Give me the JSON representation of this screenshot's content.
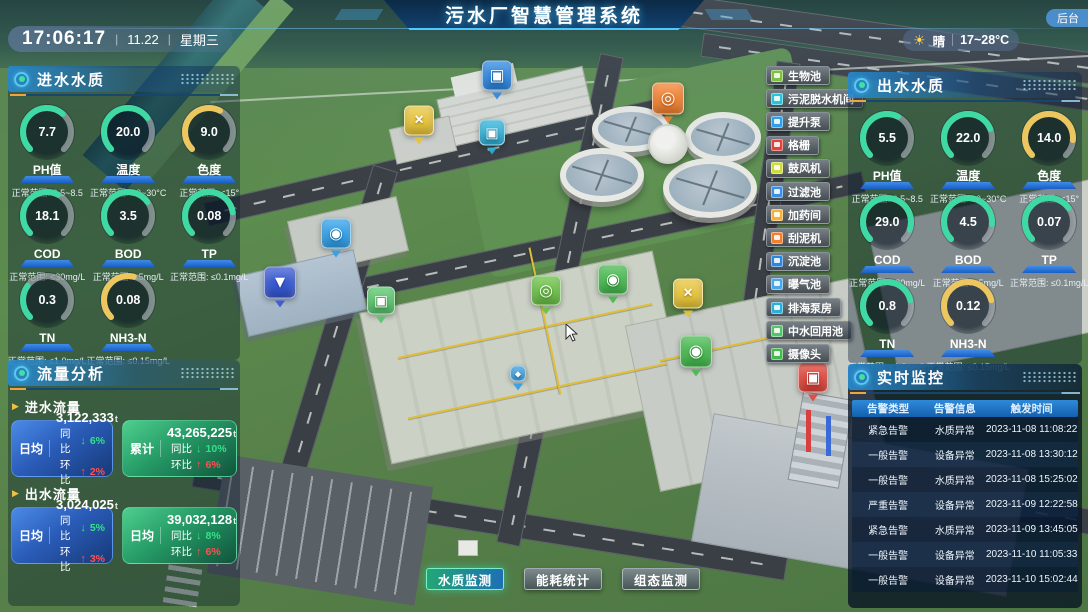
{
  "titlebar": {
    "title": "污水厂智慧管理系统",
    "backend_label": "后台",
    "clock": {
      "time": "17:06:17",
      "date": "11.22",
      "weekday": "星期三",
      "sep": "|"
    },
    "weather": {
      "icon": "☀",
      "condition": "晴",
      "temp_range": "17~28°C"
    }
  },
  "colors": {
    "gauge_green": "#3fd9a4",
    "gauge_yellow": "#ecc65e",
    "accent_cyan": "#4ec8ff",
    "up_red": "#ff5050",
    "down_green": "#35e08a",
    "card_blue": "#2f74d8",
    "card_green": "#2fae72"
  },
  "influent_panel": {
    "title": "进水水质",
    "gauges": [
      {
        "label": "PH值",
        "value": "7.7",
        "range": "正常范围: 6.5~8.5",
        "color": "green",
        "pct": 65
      },
      {
        "label": "温度",
        "value": "20.0",
        "range": "正常范围: 20~30°C",
        "color": "green",
        "pct": 70
      },
      {
        "label": "色度",
        "value": "9.0",
        "range": "正常范围: <15°",
        "color": "yellow",
        "pct": 60
      },
      {
        "label": "COD",
        "value": "18.1",
        "range": "正常范围: ≤30mg/L",
        "color": "green",
        "pct": 60
      },
      {
        "label": "BOD",
        "value": "3.5",
        "range": "正常范围: ≤5mg/L",
        "color": "green",
        "pct": 70
      },
      {
        "label": "TP",
        "value": "0.08",
        "range": "正常范围: ≤0.1mg/L",
        "color": "green",
        "pct": 80
      },
      {
        "label": "TN",
        "value": "0.3",
        "range": "正常范围: ≤1.0mg/L",
        "color": "green",
        "pct": 30
      },
      {
        "label": "NH3-N",
        "value": "0.08",
        "range": "正常范围: ≤0.15mg/L",
        "color": "yellow",
        "pct": 55
      }
    ]
  },
  "effluent_panel": {
    "title": "出水水质",
    "gauges": [
      {
        "label": "PH值",
        "value": "5.5",
        "range": "正常范围: 6.5~8.5",
        "color": "green",
        "pct": 60
      },
      {
        "label": "温度",
        "value": "22.0",
        "range": "正常范围: 20~30°C",
        "color": "green",
        "pct": 75
      },
      {
        "label": "色度",
        "value": "14.0",
        "range": "正常范围: <15°",
        "color": "yellow",
        "pct": 85
      },
      {
        "label": "COD",
        "value": "29.0",
        "range": "正常范围: ≤30mg/L",
        "color": "green",
        "pct": 90
      },
      {
        "label": "BOD",
        "value": "4.5",
        "range": "正常范围: ≤5mg/L",
        "color": "green",
        "pct": 85
      },
      {
        "label": "TP",
        "value": "0.07",
        "range": "正常范围: ≤0.1mg/L",
        "color": "green",
        "pct": 70
      },
      {
        "label": "TN",
        "value": "0.8",
        "range": "正常范围: ≤1.0mg/L",
        "color": "green",
        "pct": 78
      },
      {
        "label": "NH3-N",
        "value": "0.12",
        "range": "正常范围: ≤0.15mg/L",
        "color": "yellow",
        "pct": 78
      }
    ]
  },
  "flow_panel": {
    "title": "流量分析",
    "yoy_label": "同比",
    "mom_label": "环比",
    "groups": [
      {
        "label": "进水流量",
        "cards": [
          {
            "theme": "blue",
            "stat": "日均",
            "value": "3,122,333",
            "unit": "t",
            "yoy": "6%",
            "mom": "2%"
          },
          {
            "theme": "green",
            "stat": "累计",
            "value": "43,265,225",
            "unit": "t",
            "yoy": "10%",
            "mom": "6%"
          }
        ]
      },
      {
        "label": "出水流量",
        "cards": [
          {
            "theme": "blue",
            "stat": "日均",
            "value": "3,024,025",
            "unit": "t",
            "yoy": "5%",
            "mom": "3%"
          },
          {
            "theme": "green",
            "stat": "日均",
            "value": "39,032,128",
            "unit": "t",
            "yoy": "8%",
            "mom": "6%"
          }
        ]
      }
    ]
  },
  "monitor_panel": {
    "title": "实时监控",
    "columns": [
      "告警类型",
      "告警信息",
      "触发时间"
    ],
    "rows": [
      [
        "紧急告警",
        "水质异常",
        "2023-11-08 11:08:22"
      ],
      [
        "一般告警",
        "设备异常",
        "2023-11-08 13:30:12"
      ],
      [
        "一般告警",
        "水质异常",
        "2023-11-08 15:25:02"
      ],
      [
        "严重告警",
        "设备异常",
        "2023-11-09 12:22:58"
      ],
      [
        "紧急告警",
        "水质异常",
        "2023-11-09 13:45:05"
      ],
      [
        "一般告警",
        "设备异常",
        "2023-11-10 11:05:33"
      ],
      [
        "一般告警",
        "设备异常",
        "2023-11-10 15:02:44"
      ]
    ]
  },
  "facility_buttons": [
    {
      "label": "生物池",
      "color": "#7cc142"
    },
    {
      "label": "污泥脱水机间",
      "color": "#29c5d6"
    },
    {
      "label": "提升泵",
      "color": "#2e9fe8"
    },
    {
      "label": "格栅",
      "color": "#e04438"
    },
    {
      "label": "鼓风机",
      "color": "#cfdd3c"
    },
    {
      "label": "过滤池",
      "color": "#3a8ee6"
    },
    {
      "label": "加药间",
      "color": "#f2b03c"
    },
    {
      "label": "刮泥机",
      "color": "#f08030"
    },
    {
      "label": "沉淀池",
      "color": "#2b86e0"
    },
    {
      "label": "曝气池",
      "color": "#4aa8e8"
    },
    {
      "label": "排海泵房",
      "color": "#2bb0d8"
    },
    {
      "label": "中水回用池",
      "color": "#56c46a"
    },
    {
      "label": "摄像头",
      "color": "#46b84e"
    }
  ],
  "bottom_tabs": [
    {
      "label": "水质监测",
      "active": true
    },
    {
      "label": "能耗统计",
      "active": false
    },
    {
      "label": "组态监测",
      "active": false
    }
  ],
  "scene_icons": [
    {
      "name": "settling-pool-icon",
      "glyph": "▣",
      "color": "#2b86e0",
      "x": 497,
      "y": 80,
      "size": 30
    },
    {
      "name": "scraper-icon",
      "glyph": "◎",
      "color": "#f08030",
      "x": 668,
      "y": 103,
      "size": 32
    },
    {
      "name": "blower-fan-icon",
      "glyph": "×",
      "color": "#e6c33a",
      "x": 419,
      "y": 125,
      "size": 30
    },
    {
      "name": "dewatering-icon",
      "glyph": "▣",
      "color": "#2bb0d8",
      "x": 492,
      "y": 137,
      "size": 26
    },
    {
      "name": "lift-pump-icon",
      "glyph": "◉",
      "color": "#2e9fe8",
      "x": 336,
      "y": 238,
      "size": 30
    },
    {
      "name": "filter-pool-icon",
      "glyph": "▼",
      "color": "#3657d0",
      "x": 280,
      "y": 287,
      "size": 32
    },
    {
      "name": "reuse-pool-icon",
      "glyph": "▣",
      "color": "#56c46a",
      "x": 381,
      "y": 305,
      "size": 28
    },
    {
      "name": "bio-pool-icon",
      "glyph": "◎",
      "color": "#6abf45",
      "x": 546,
      "y": 295,
      "size": 30
    },
    {
      "name": "camera-icon",
      "glyph": "◉",
      "color": "#46b84e",
      "x": 613,
      "y": 284,
      "size": 30
    },
    {
      "name": "aeration-fan-icon",
      "glyph": "×",
      "color": "#e6c33a",
      "x": 688,
      "y": 298,
      "size": 30
    },
    {
      "name": "camera-icon-2",
      "glyph": "◉",
      "color": "#46b84e",
      "x": 696,
      "y": 356,
      "size": 32
    },
    {
      "name": "grille-icon",
      "glyph": "▣",
      "color": "#e04438",
      "x": 813,
      "y": 382,
      "size": 30
    },
    {
      "name": "outfall-pump-icon",
      "glyph": "◆",
      "color": "#2e9fe8",
      "x": 518,
      "y": 378,
      "size": 16
    }
  ]
}
